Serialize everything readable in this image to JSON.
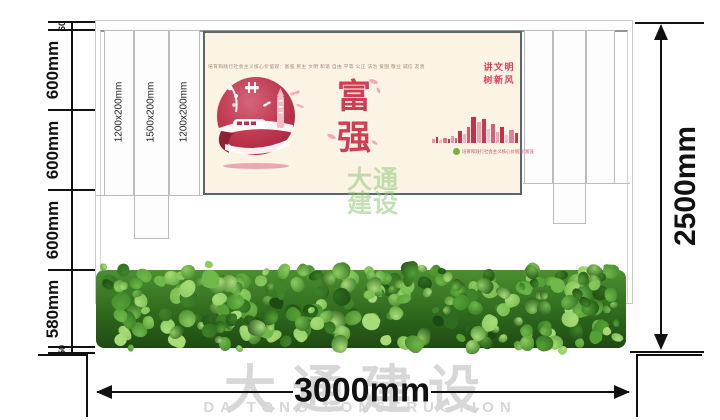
{
  "dimensions": {
    "left_chain": [
      "60",
      "600mm",
      "600mm",
      "600mm",
      "580mm",
      "50"
    ],
    "height_total": "2500mm",
    "width_total": "3000mm"
  },
  "structure": {
    "slat_labels": [
      "1200x200mm",
      "1500x200mm",
      "1200x200mm"
    ]
  },
  "poster": {
    "top_caption": "培育和践行社会主义核心价值观：富强 民主 文明 和谐 自由 平等 公正 法治 爱国 敬业 诚信 友善",
    "main_chars": [
      "富",
      "强"
    ],
    "side_slogan_lines": [
      "讲文明",
      "树新风"
    ],
    "bottom_caption": "培育和践行社会主义核心价值观 富强",
    "colors": {
      "background": "#fbf3e4",
      "accent_red": "#d23d56",
      "crimson": "#c4314b",
      "pink": "#eaa6b2",
      "green_dot": "#76b043"
    },
    "skyline_bars": [
      {
        "w": 3,
        "h": 4,
        "c": "#e59aa6"
      },
      {
        "w": 2,
        "h": 6,
        "c": "#c4314b"
      },
      {
        "w": 3,
        "h": 3,
        "c": "#eeb7c0"
      },
      {
        "w": 4,
        "h": 5,
        "c": "#d97487"
      },
      {
        "w": 2,
        "h": 4,
        "c": "#c4314b"
      },
      {
        "w": 3,
        "h": 7,
        "c": "#e59aa6"
      },
      {
        "w": 2,
        "h": 5,
        "c": "#d9566d"
      },
      {
        "w": 4,
        "h": 12,
        "c": "#c4314b"
      },
      {
        "w": 3,
        "h": 9,
        "c": "#eeb7c0"
      },
      {
        "w": 3,
        "h": 16,
        "c": "#d9566d"
      },
      {
        "w": 5,
        "h": 26,
        "c": "#c4314b"
      },
      {
        "w": 4,
        "h": 21,
        "c": "#eaa6b2"
      },
      {
        "w": 4,
        "h": 24,
        "c": "#c73953"
      },
      {
        "w": 3,
        "h": 14,
        "c": "#f0c3cb"
      },
      {
        "w": 4,
        "h": 19,
        "c": "#d06379"
      },
      {
        "w": 3,
        "h": 11,
        "c": "#eaa6b2"
      },
      {
        "w": 4,
        "h": 16,
        "c": "#c4314b"
      },
      {
        "w": 3,
        "h": 8,
        "c": "#f0c3cb"
      },
      {
        "w": 5,
        "h": 13,
        "c": "#db8496"
      },
      {
        "w": 3,
        "h": 10,
        "c": "#c73953"
      }
    ]
  },
  "watermark": {
    "company_cn": "大通建设",
    "company_en": "DA TONG CONSTRUCTION",
    "stamp_lines": [
      "大通",
      "建设"
    ]
  },
  "hedge": {
    "color_palette": [
      "#1d4a12",
      "#2e6b1f",
      "#3f8428",
      "#55a135",
      "#6fb84a",
      "#8ccb60",
      "#a9dc78"
    ]
  }
}
